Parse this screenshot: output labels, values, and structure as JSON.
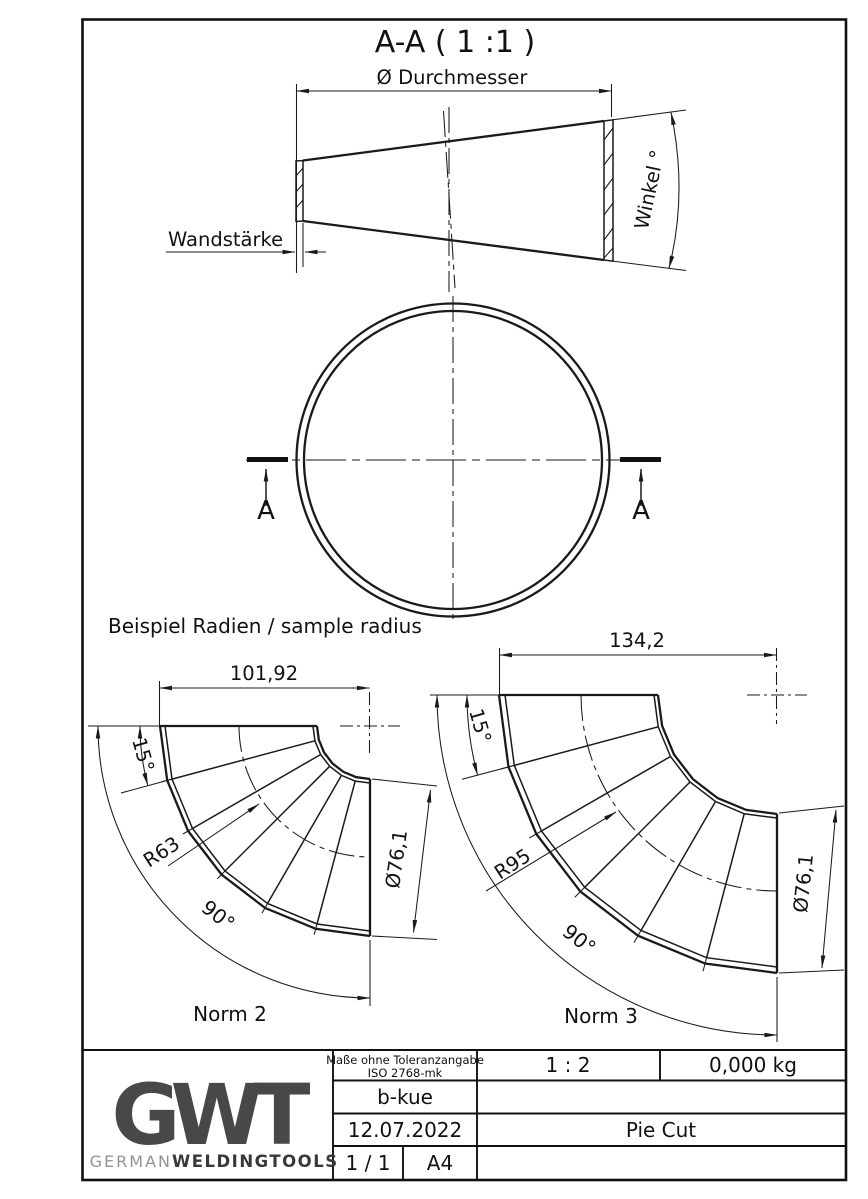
{
  "section_title": "A-A ( 1 :1 )",
  "cone_view": {
    "diameter_label": "Ø Durchmesser",
    "wall_label": "Wandstärke",
    "angle_label": "Winkel °"
  },
  "plan_view": {
    "cut_label_left": "A",
    "cut_label_right": "A"
  },
  "samples_heading": "Beispiel Radien / sample radius",
  "norm2": {
    "name": "Norm 2",
    "length": "101,92",
    "segment_angle": "15°",
    "radius": "R63",
    "bend_angle": "90°",
    "diameter": "Ø76,1"
  },
  "norm3": {
    "name": "Norm 3",
    "length": "134,2",
    "segment_angle": "15°",
    "radius": "R95",
    "bend_angle": "90°",
    "diameter": "Ø76,1"
  },
  "title_block": {
    "tolerance_note_line1": "Maße ohne Toleranzangabe",
    "tolerance_note_line2": "ISO 2768-mk",
    "scale": "1 : 2",
    "weight": "0,000 kg",
    "author": "b-kue",
    "date": "12.07.2022",
    "part_title": "Pie Cut",
    "sheet": "1 / 1",
    "paper_size": "A4",
    "logo_acronym": "GWT",
    "brand_regular": "GERMAN",
    "brand_bold": "WELDINGTOOLS"
  },
  "colors": {
    "line": "#1a1a1a",
    "logo_dark": "#48484b",
    "logo_light": "#939395",
    "background": "#ffffff"
  }
}
